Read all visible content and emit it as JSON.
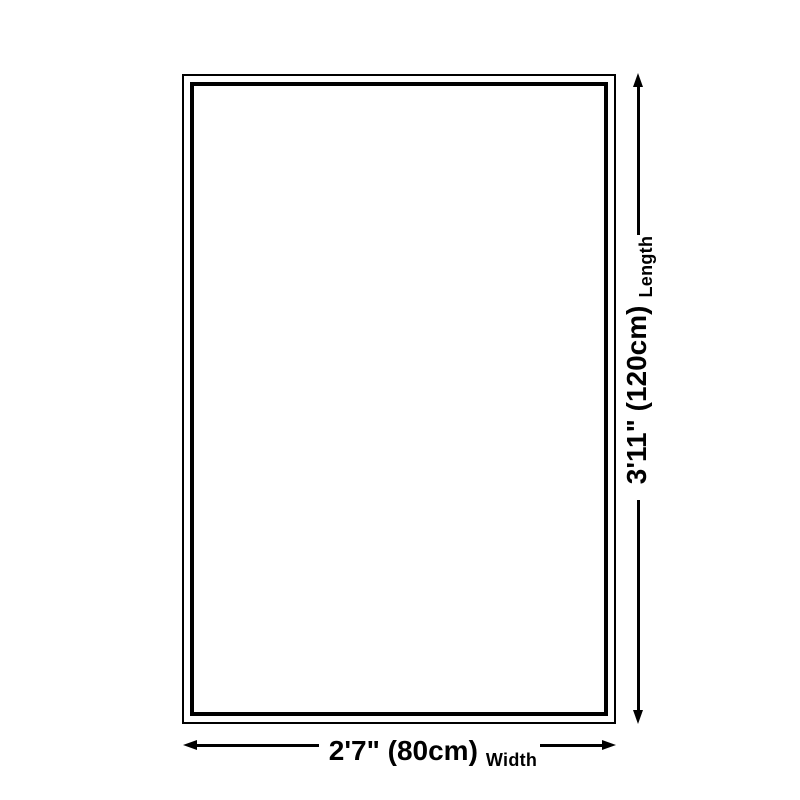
{
  "diagram": {
    "type": "product-size-dimension-diagram",
    "colors": {
      "background": "#ffffff",
      "outline": "#000000",
      "dimension_lines": "#000000",
      "text": "#000000"
    },
    "length": {
      "value": "3'11\" (120cm)",
      "label": "Length"
    },
    "width": {
      "value": "2'7\" (80cm)",
      "label": "Width"
    }
  }
}
